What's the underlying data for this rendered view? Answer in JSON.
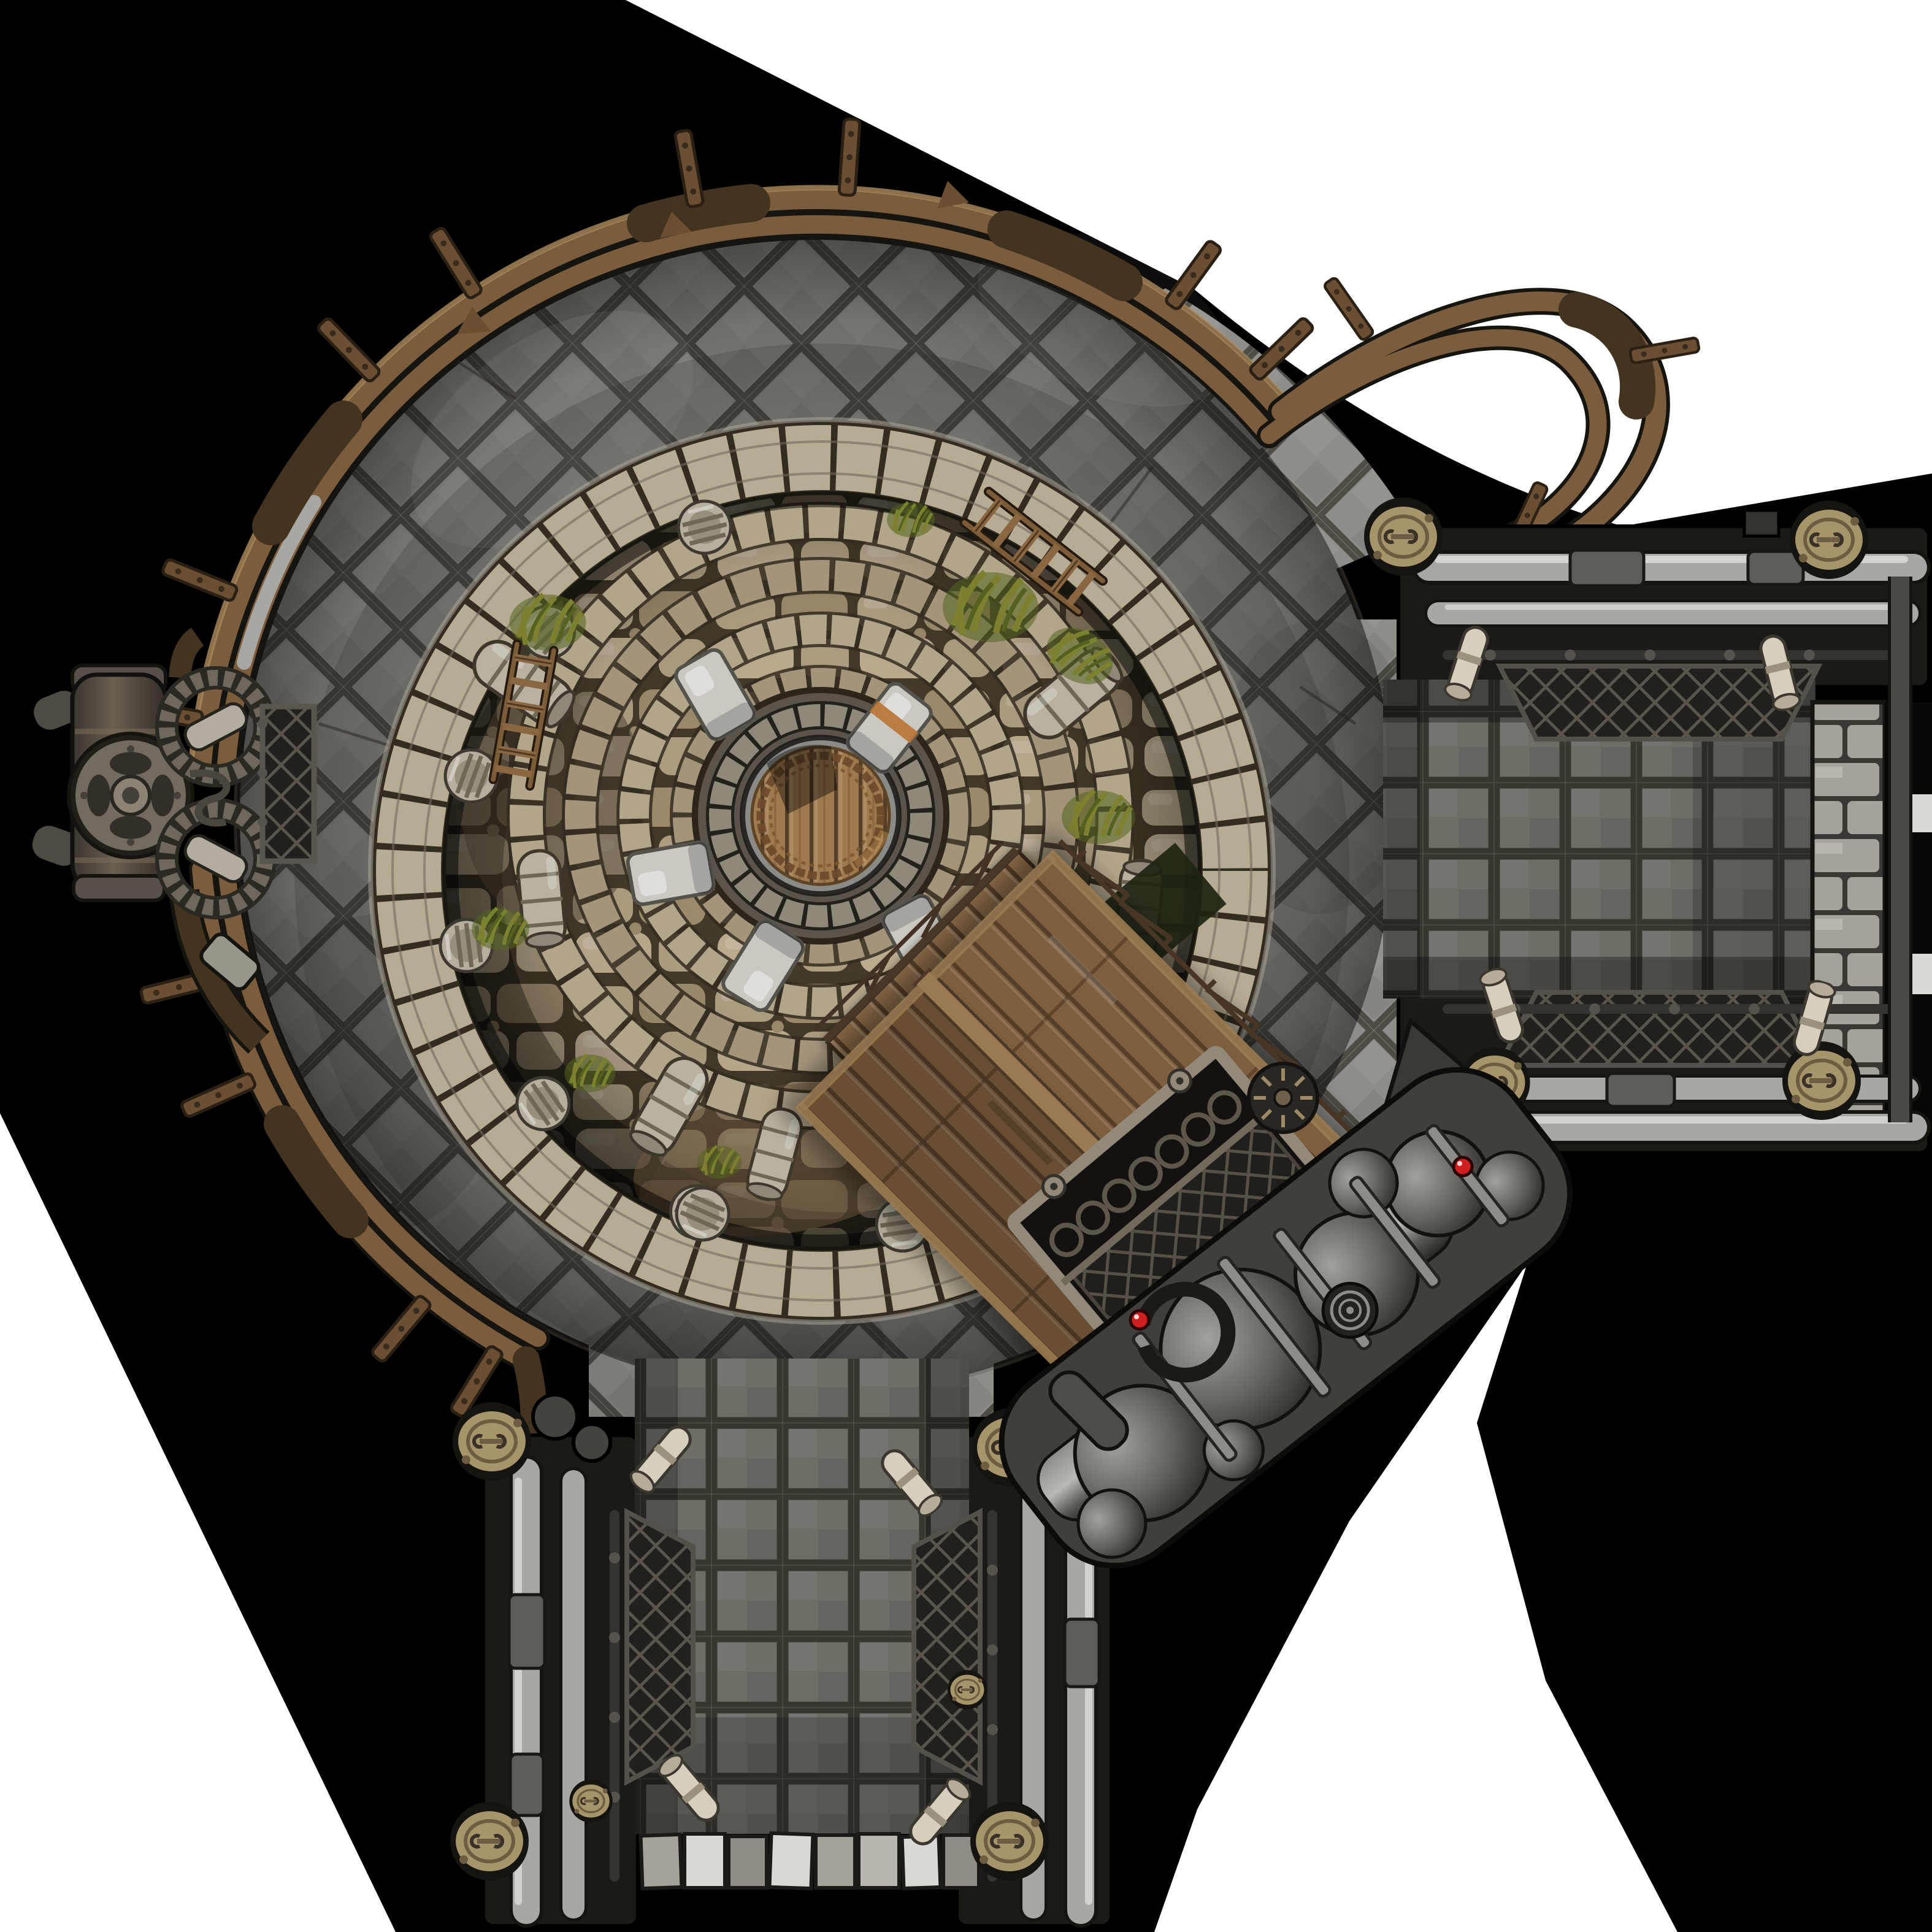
{
  "scene": {
    "title": "Steampunk arena battle map (top-down)",
    "style": "hand-painted fantasy RPG map tile",
    "regions": {
      "central_chamber": "large circular stone-tiled chamber ringed by bronze pipes",
      "sunken_pit": "circular excavated rock pit with concentric stone rings",
      "central_hatch": "round wooden hatch with ornate metal border, clamped by stone blocks",
      "east_corridor": "pipe-walled room exit to the east, closed by a stone block wall",
      "south_corridor": "pipe-walled corridor exit to the south with stone threshold",
      "west_machine": "iron pump-valve machine with flywheel and gear rings",
      "boiler_train": "diagonal assembly of dark boilers, tanks and flanged pipes",
      "wooden_shack": "gabled plank roof structure at the pit's south-east edge",
      "ramp": "railed wooden walkway descending from the hatch to the shack",
      "cage": "grated iron cage beside the boiler train"
    },
    "counts": {
      "clamp_stones_on_hatch": 5,
      "pillar_stubs_in_pit": 9,
      "fallen_column_drums": 6,
      "ladders": 2,
      "grass_tufts": 8,
      "brass_couplers": 12,
      "pipe_clamp_bands": 15,
      "threshold_blocks": 8,
      "red_indicator_lights": 2
    }
  },
  "palette": {
    "bg_outer": "#ffffff",
    "bg_shadow": "#000000",
    "floor_tile": "#8e8d87",
    "floor_base": "#7d7c75",
    "floor_seam": "#4e4c45",
    "cor_tile": "#6e6d66",
    "cor_base": "#585750",
    "cor_seam": "#37362f",
    "pit_rock1": "#b3a485",
    "pit_rock2": "#a19070",
    "pit_rock3": "#c2b294",
    "pit_gap": "#453c2b",
    "ringwall_light": "#b6ac93",
    "ringwall_dark": "#332c20",
    "ring_stone1": "#b2a68a",
    "ring_stone2": "#a2957a",
    "center_rock": "#5a544a",
    "hatch_steel": "#8b8b85",
    "wood_light": "#9f7a4e",
    "wood_mid": "#7c5c38",
    "wood_dark": "#543e27",
    "ornate": "#6b4a2a",
    "clamp_stone": "#cbc8c1",
    "copper": "#b87333",
    "pipe_bronze": "#7b5c3d",
    "pipe_bronze_hi": "#ab8a5d",
    "pipe_bronze_dark": "#43341f",
    "clamp_band": "#6b4f33",
    "silver": "#a8a7a1",
    "silver_hi": "#d9d8d2",
    "silver_dark": "#4a4944",
    "outline": "#15140f",
    "brass": "#a6946a",
    "brass_dark": "#6c5d40",
    "mesh_bg": "#22201d",
    "mesh_line": "#5a544a",
    "stone_block": "#a5a29a",
    "white_block": "#dad8d2",
    "machine_dark": "#454340",
    "sphere_hi": "#a3a19c",
    "sphere_dark": "#33312d",
    "red_light": "#cf1f1f",
    "grass1": "#7b812f",
    "grass2": "#55621f",
    "shack_mid": "#7d5f3f",
    "ramp_mid": "#8a6b49",
    "beam": "#9a7a52",
    "cage_frame": "#93897a"
  }
}
